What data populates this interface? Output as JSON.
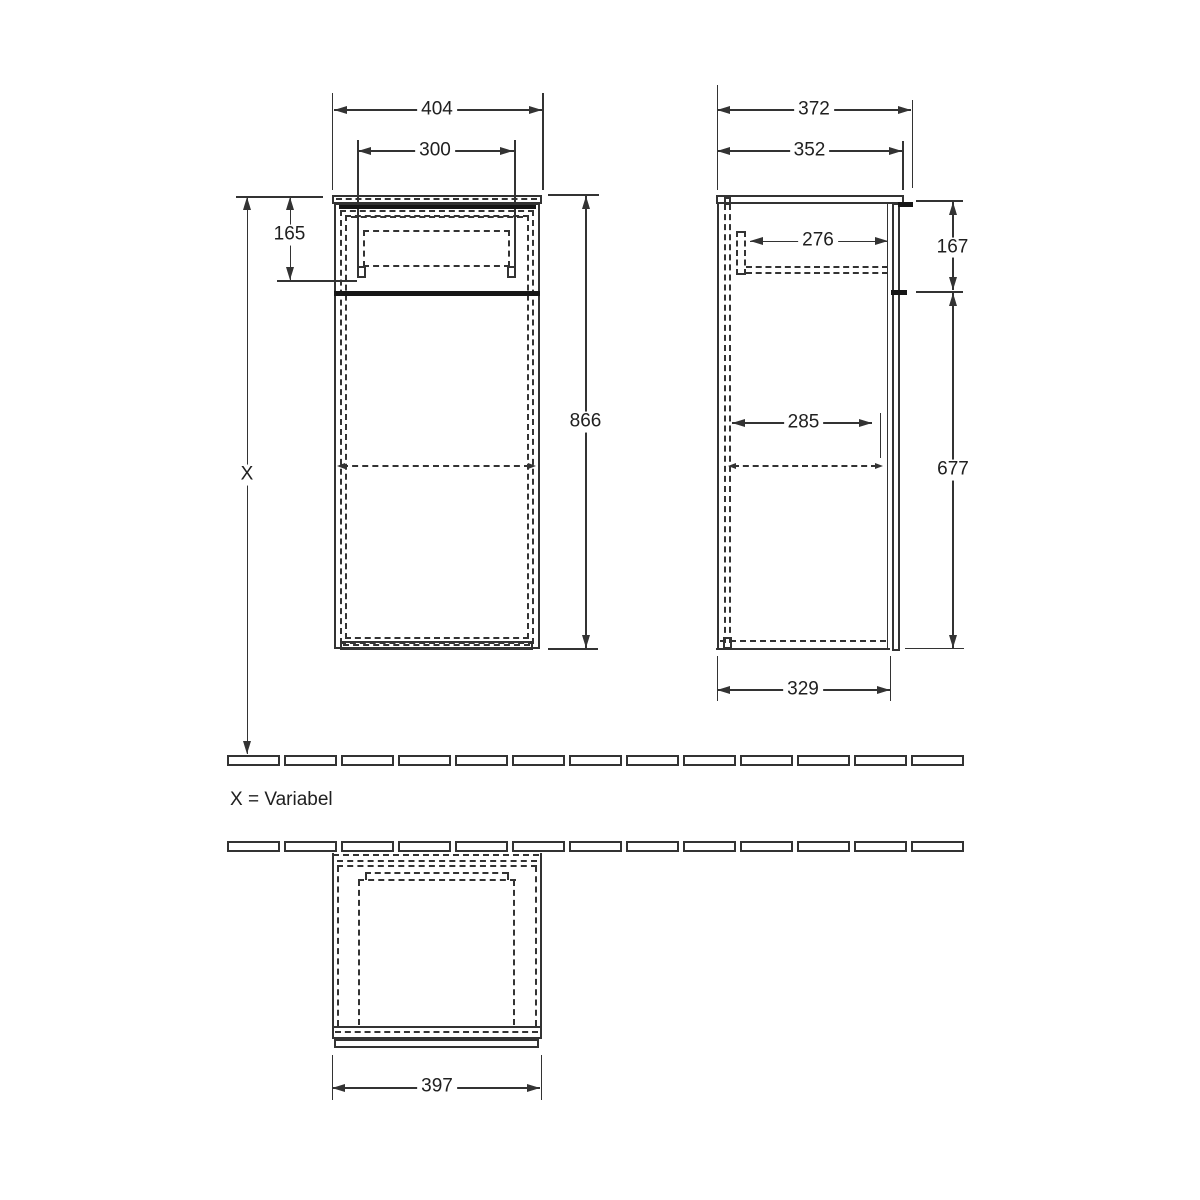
{
  "note": "X = Variabel",
  "colors": {
    "line": "#333333",
    "accent_dark": "#161616",
    "background": "#ffffff",
    "text": "#202020"
  },
  "dims": {
    "front": {
      "outer_width": "404",
      "inner_width": "300",
      "drawer_zone_height": "165",
      "carcass_height": "866",
      "install_height": "X"
    },
    "side": {
      "overall_depth": "372",
      "top_depth": "352",
      "inner_depth": "276",
      "top_section_height": "167",
      "shelf_depth": "285",
      "lower_section_height": "677",
      "base_depth": "329"
    },
    "top": {
      "outer_width": "397"
    }
  }
}
